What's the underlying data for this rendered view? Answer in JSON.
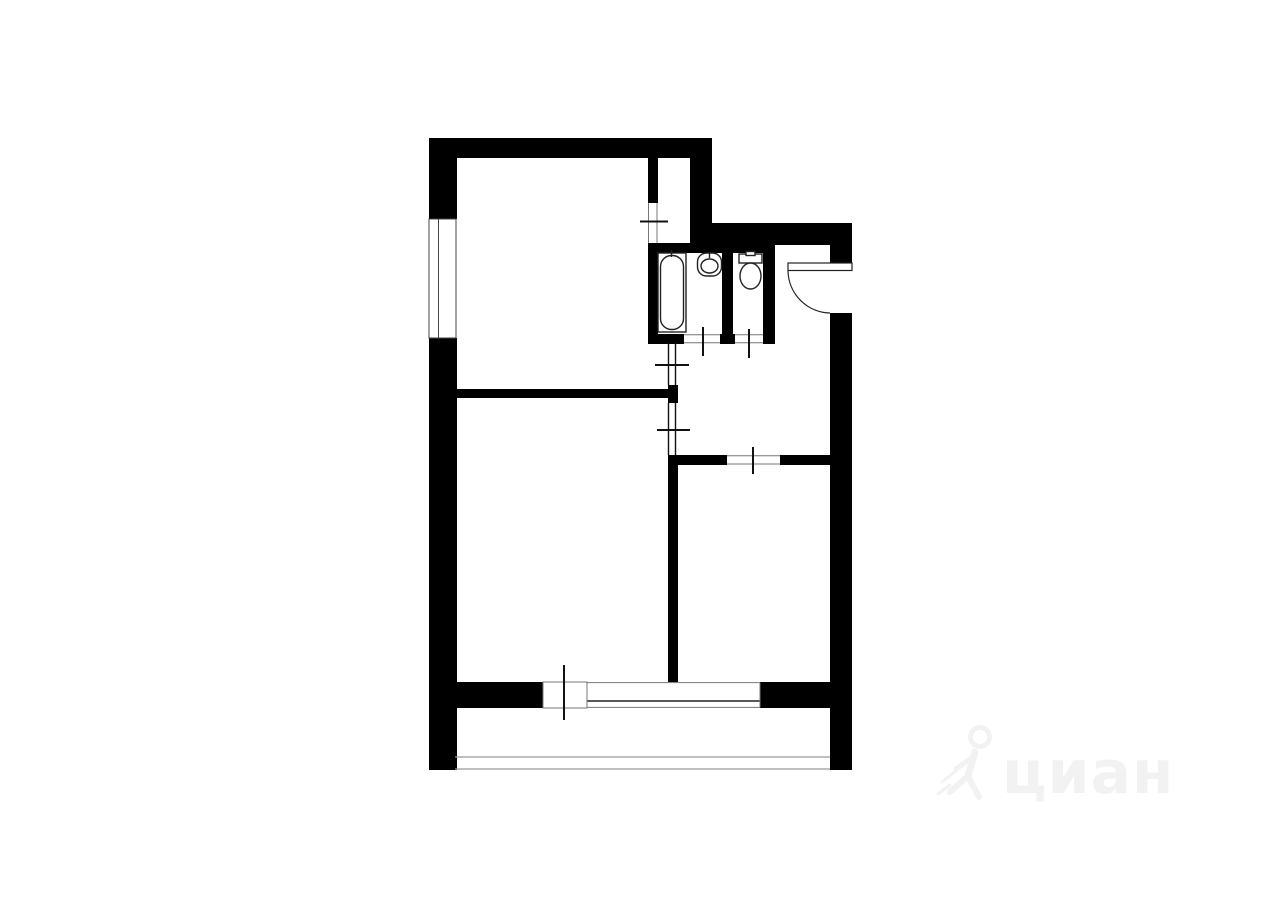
{
  "canvas": {
    "width": 1280,
    "height": 905,
    "background": "#ffffff"
  },
  "watermark": {
    "text": "циан",
    "logo": "walking-person-icon",
    "color": "#f2f2f2",
    "text_x": 1002,
    "text_y": 793,
    "figure": {
      "head": {
        "cx": 980,
        "cy": 737,
        "r": 9.5,
        "stroke_width": 5
      },
      "strokes": [
        {
          "d": "M 975 752 L 968 776",
          "w": 7
        },
        {
          "d": "M 968 776 L 979 797",
          "w": 6
        },
        {
          "d": "M 968 776 L 950 792",
          "w": 6
        },
        {
          "d": "M 974 756 L 956 769",
          "w": 5
        },
        {
          "d": "M 942 782 L 957 770",
          "w": 3
        },
        {
          "d": "M 938 794 L 950 785",
          "w": 3
        }
      ]
    }
  },
  "floorplan": {
    "colors": {
      "wall": "#000000",
      "fixture_line": "#222222",
      "tick": "#111111",
      "thin_partition": "#111111",
      "opening_edge": "#777777",
      "window_edge": "#444444",
      "balcony_line": "#999999",
      "glass_line": "#222222"
    },
    "walls": [
      {
        "name": "top-wall-outer",
        "x": 429,
        "y": 138,
        "w": 283,
        "h": 20
      },
      {
        "name": "left-wall-upper",
        "x": 429,
        "y": 138,
        "w": 28,
        "h": 81
      },
      {
        "name": "left-wall-lower",
        "x": 429,
        "y": 338,
        "w": 28,
        "h": 432
      },
      {
        "name": "step-wall-outer",
        "x": 690,
        "y": 138,
        "w": 22,
        "h": 107
      },
      {
        "name": "hall-top-wall-outer",
        "x": 690,
        "y": 223,
        "w": 162,
        "h": 22
      },
      {
        "name": "right-wall-upper",
        "x": 830,
        "y": 245,
        "w": 22,
        "h": 18
      },
      {
        "name": "right-wall-lower",
        "x": 830,
        "y": 313,
        "w": 22,
        "h": 457
      },
      {
        "name": "bottom-wall-left",
        "x": 455,
        "y": 682,
        "w": 88,
        "h": 26
      },
      {
        "name": "bottom-wall-right",
        "x": 760,
        "y": 682,
        "w": 70,
        "h": 26
      },
      {
        "name": "closet-partition",
        "x": 648,
        "y": 158,
        "w": 10,
        "h": 45
      },
      {
        "name": "sanitary-block-top-wall",
        "x": 648,
        "y": 243,
        "w": 127,
        "h": 10
      },
      {
        "name": "bathroom-left-wall",
        "x": 648,
        "y": 253,
        "w": 10,
        "h": 90
      },
      {
        "name": "bath-toilet-divider",
        "x": 722,
        "y": 253,
        "w": 11,
        "h": 81
      },
      {
        "name": "divider-bottom-seg",
        "x": 720,
        "y": 334,
        "w": 15,
        "h": 10
      },
      {
        "name": "toilet-right-wall",
        "x": 763,
        "y": 253,
        "w": 12,
        "h": 91
      },
      {
        "name": "bathroom-bottom-seg",
        "x": 648,
        "y": 334,
        "w": 36,
        "h": 10
      },
      {
        "name": "hall-partition-block",
        "x": 668,
        "y": 385,
        "w": 10,
        "h": 18
      },
      {
        "name": "rooms-divider-wall",
        "x": 429,
        "y": 389,
        "w": 239,
        "h": 9
      },
      {
        "name": "hall-room-wall-left",
        "x": 668,
        "y": 455,
        "w": 59,
        "h": 10
      },
      {
        "name": "hall-room-wall-right",
        "x": 780,
        "y": 455,
        "w": 50,
        "h": 10
      },
      {
        "name": "rooms-divider-vertical",
        "x": 668,
        "y": 455,
        "w": 10,
        "h": 227
      }
    ],
    "left_window": {
      "name": "left-wall-window",
      "frame": {
        "x": 429,
        "y": 219,
        "w": 27,
        "h": 119
      },
      "inner_line_x": 438.5
    },
    "balcony_door_gap": {
      "name": "balcony-door-opening",
      "x": 543,
      "y": 682,
      "w": 44,
      "h": 26
    },
    "balcony_window": {
      "name": "balcony-window",
      "x1": 587,
      "x2": 760,
      "y_top": 682.6,
      "y_mid": 701,
      "y_bottom": 707.4
    },
    "opening_edge_lines": [
      {
        "name": "closet-door-opening-edge",
        "x1": 648.5,
        "y1": 203,
        "x2": 648.5,
        "y2": 243
      },
      {
        "name": "closet-door-opening-edge",
        "x1": 657,
        "y1": 203,
        "x2": 657,
        "y2": 243
      },
      {
        "name": "room-door-opening-edge",
        "x1": 727,
        "y1": 455.7,
        "x2": 780,
        "y2": 455.7
      },
      {
        "name": "room-door-opening-edge",
        "x1": 727,
        "y1": 464,
        "x2": 780,
        "y2": 464
      },
      {
        "name": "bathroom-door-opening-edge",
        "x1": 684,
        "y1": 334.7,
        "x2": 720,
        "y2": 334.7
      },
      {
        "name": "bathroom-door-opening-edge",
        "x1": 684,
        "y1": 342.7,
        "x2": 720,
        "y2": 342.7
      },
      {
        "name": "toilet-door-opening-edge",
        "x1": 735,
        "y1": 334.7,
        "x2": 763,
        "y2": 334.7
      },
      {
        "name": "toilet-door-opening-edge",
        "x1": 735,
        "y1": 342.7,
        "x2": 763,
        "y2": 342.7
      }
    ],
    "thin_partition_lines": [
      {
        "name": "hall-thin-partition",
        "x1": 668.5,
        "y1": 343,
        "x2": 668.5,
        "y2": 385
      },
      {
        "name": "hall-thin-partition",
        "x1": 675.5,
        "y1": 343,
        "x2": 675.5,
        "y2": 385
      },
      {
        "name": "hall-thin-partition",
        "x1": 668.5,
        "y1": 403,
        "x2": 668.5,
        "y2": 455
      },
      {
        "name": "hall-thin-partition",
        "x1": 675.5,
        "y1": 403,
        "x2": 675.5,
        "y2": 455
      }
    ],
    "balcony_lines": [
      {
        "name": "balcony-inner-line",
        "x1": 455,
        "y1": 757,
        "x2": 830,
        "y2": 757
      },
      {
        "name": "balcony-outer-line",
        "x1": 455,
        "y1": 769,
        "x2": 830,
        "y2": 769
      }
    ],
    "door_ticks": [
      {
        "name": "closet-door-tick",
        "x1": 640,
        "y1": 221.5,
        "x2": 668,
        "y2": 221.5
      },
      {
        "name": "kitchen-doorway-tick",
        "x1": 655,
        "y1": 365,
        "x2": 689,
        "y2": 365
      },
      {
        "name": "room1-doorway-tick",
        "x1": 657,
        "y1": 430,
        "x2": 690,
        "y2": 430
      },
      {
        "name": "bathroom-door-tick",
        "x1": 703,
        "y1": 327,
        "x2": 703,
        "y2": 356
      },
      {
        "name": "toilet-door-tick",
        "x1": 749,
        "y1": 329,
        "x2": 749,
        "y2": 358
      },
      {
        "name": "room2-door-tick",
        "x1": 753,
        "y1": 447,
        "x2": 753,
        "y2": 474
      },
      {
        "name": "balcony-door-tick",
        "x1": 564,
        "y1": 665,
        "x2": 564,
        "y2": 720
      }
    ],
    "entrance_door": {
      "name": "entrance-door",
      "opening": {
        "x": 830,
        "y": 263,
        "w": 22,
        "h": 50
      },
      "leaf": {
        "x": 788,
        "y": 263,
        "w": 64,
        "h": 7.5
      },
      "arc_path": "M 788 271 A 43 43 0 0 0 830 313"
    },
    "fixtures": [
      {
        "kind": "rect",
        "name": "bathtub-outer",
        "x": 658,
        "y": 253,
        "w": 28,
        "h": 79
      },
      {
        "kind": "rrect",
        "name": "bathtub-inner",
        "x": 660.5,
        "y": 255.5,
        "w": 23,
        "h": 74,
        "r": 11
      },
      {
        "kind": "line",
        "name": "bathtub-tap",
        "x1": 671.5,
        "y1": 250,
        "x2": 671.5,
        "y2": 257
      },
      {
        "kind": "rrect",
        "name": "sink",
        "x": 697.5,
        "y": 253,
        "w": 24,
        "h": 23,
        "r": 9
      },
      {
        "kind": "ellipse",
        "name": "sink-bowl",
        "cx": 709.5,
        "cy": 266,
        "rx": 8.5,
        "ry": 7
      },
      {
        "kind": "line",
        "name": "sink-tap",
        "x1": 709.5,
        "y1": 253,
        "x2": 709.5,
        "y2": 258
      },
      {
        "kind": "rect",
        "name": "toilet-tank",
        "x": 739,
        "y": 254,
        "w": 23,
        "h": 9
      },
      {
        "kind": "rect",
        "name": "toilet-button",
        "x": 746,
        "y": 251.5,
        "w": 9,
        "h": 4
      },
      {
        "kind": "ellipse",
        "name": "toilet-bowl",
        "cx": 750.5,
        "cy": 276,
        "rx": 10.5,
        "ry": 13
      }
    ]
  }
}
